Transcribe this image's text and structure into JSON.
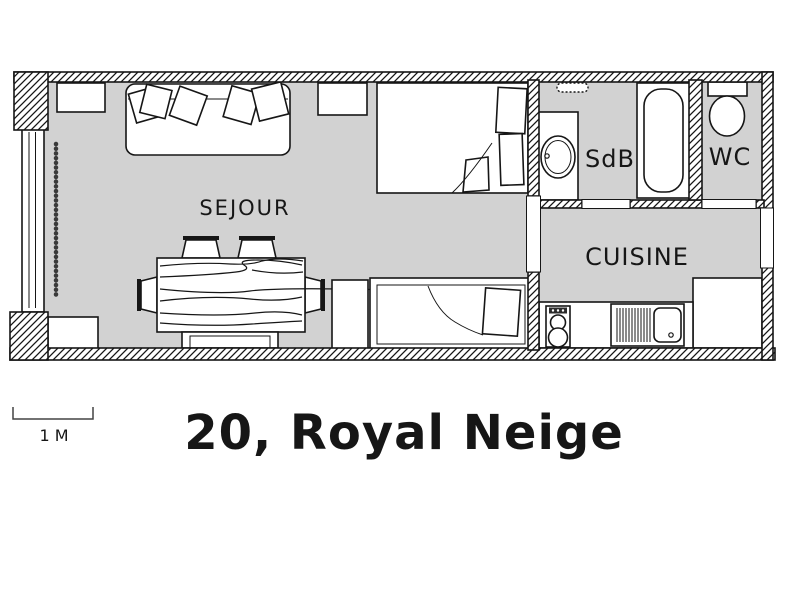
{
  "page": {
    "title": "20, Royal Neige",
    "scale_label": "1 M"
  },
  "rooms": {
    "sejour": {
      "label": "SEJOUR"
    },
    "sdb": {
      "label": "SdB"
    },
    "wc": {
      "label": "WC"
    },
    "cuisine": {
      "label": "CUISINE"
    }
  },
  "colors": {
    "floor": "#d2d2d2",
    "line": "#161616",
    "background": "#ffffff"
  },
  "furniture_icons": [
    "sofa-icon",
    "cushion-icon",
    "double-bed-icon",
    "single-bed-icon",
    "nightstand-icon",
    "shelf-icon",
    "dining-table-icon",
    "chair-icon",
    "bench-icon",
    "window-icon",
    "curtain-icon",
    "washbasin-icon",
    "bathtub-icon",
    "towel-rail-icon",
    "toilet-icon",
    "kitchen-counter-icon",
    "stove-icon",
    "dish-drainer-icon",
    "kitchen-sink-icon"
  ]
}
